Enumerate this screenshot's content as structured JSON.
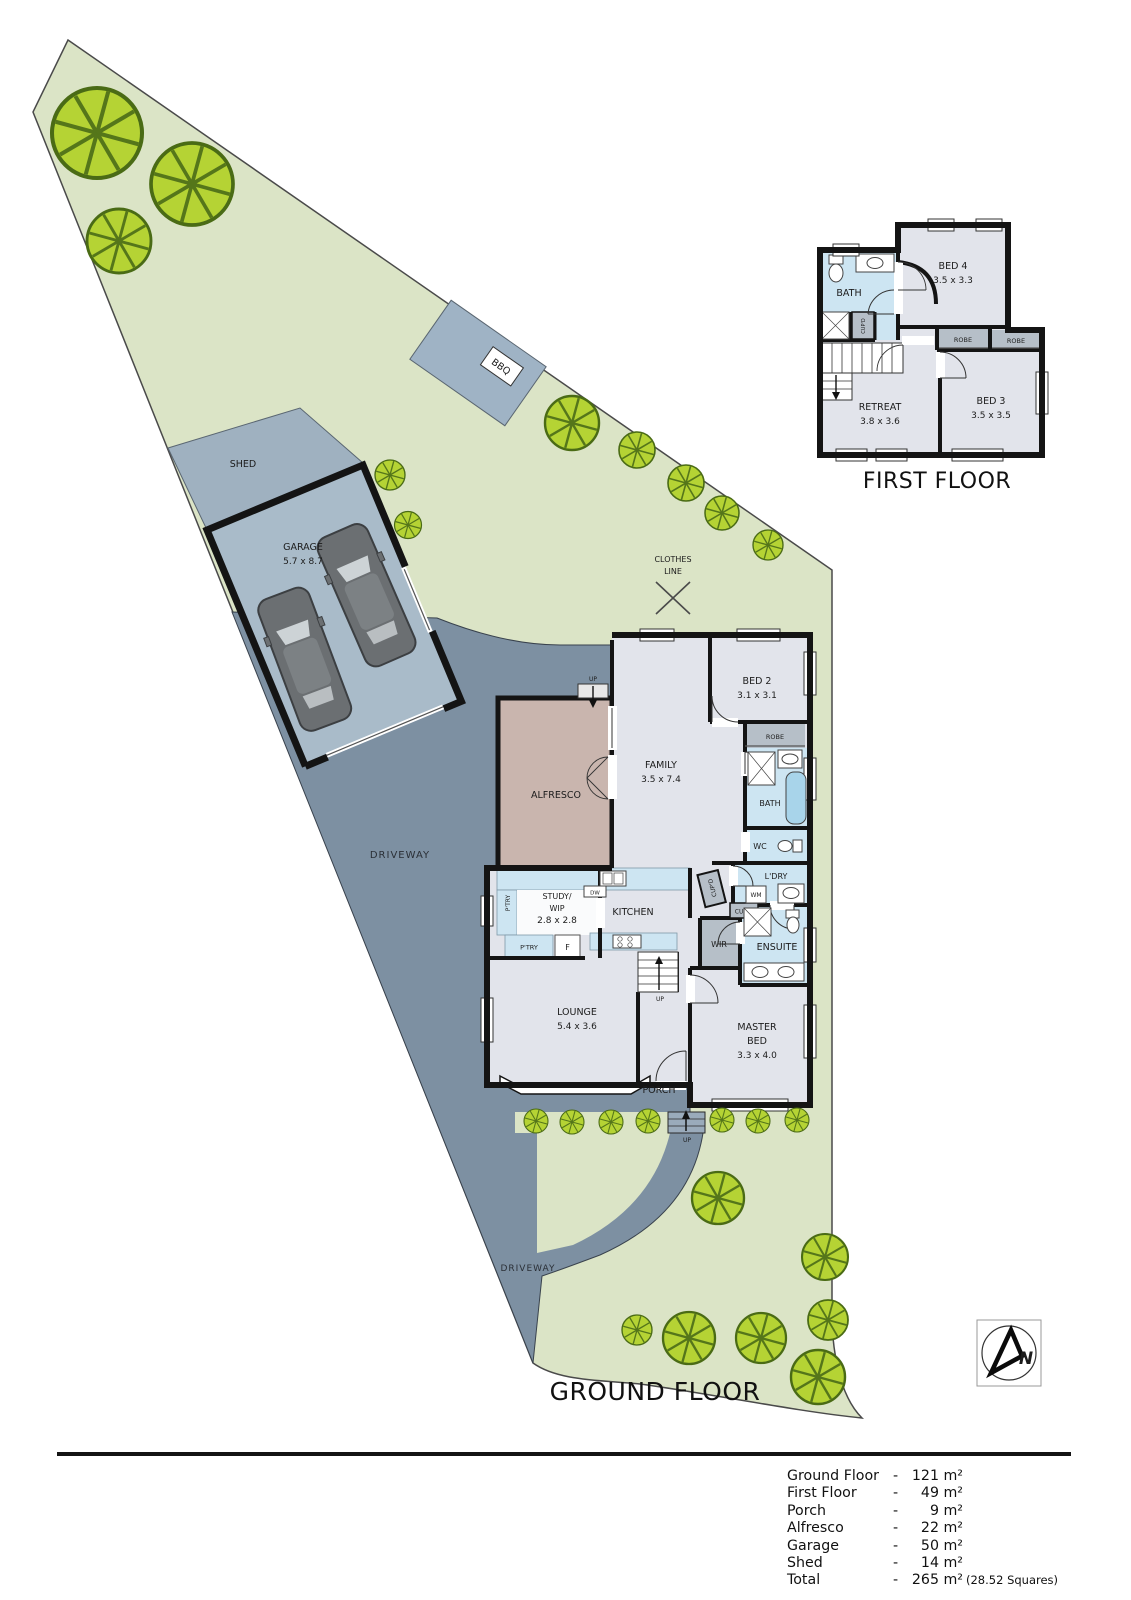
{
  "titles": {
    "first_floor": "FIRST FLOOR",
    "ground_floor": "GROUND FLOOR"
  },
  "site": {
    "shed": "SHED",
    "garage_name": "GARAGE",
    "garage_dims": "5.7 x 8.7",
    "bbq": "BBQ",
    "clothes_line_1": "CLOTHES",
    "clothes_line_2": "LINE",
    "driveway_upper": "DRIVEWAY",
    "driveway_lower": "DRIVEWAY",
    "porch": "PORCH"
  },
  "ground": {
    "family_name": "FAMILY",
    "family_dims": "3.5 x 7.4",
    "bed2_name": "BED 2",
    "bed2_dims": "3.1 x 3.1",
    "robe": "ROBE",
    "bath": "BATH",
    "wc": "WC",
    "ldry": "L'DRY",
    "wm": "WM",
    "cupd_vert": "CUP'D",
    "cupd_horiz": "CUP'D",
    "ensuite": "ENSUITE",
    "wir": "WIR",
    "master_1": "MASTER",
    "master_2": "BED",
    "master_dims": "3.3 x 4.0",
    "kitchen": "KITCHEN",
    "dw": "DW",
    "study_1": "STUDY/",
    "study_2": "WIP",
    "study_dims": "2.8 x 2.8",
    "ptry_vert": "P'TRY",
    "ptry_horiz": "P'TRY",
    "fridge": "F",
    "lounge_name": "LOUNGE",
    "lounge_dims": "5.4 x 3.6",
    "alfresco": "ALFRESCO",
    "up_alfresco": "UP",
    "up_stairs": "UP",
    "up_porch": "UP"
  },
  "first": {
    "bath": "BATH",
    "bed4_name": "BED 4",
    "bed4_dims": "3.5 x 3.3",
    "robe_left": "ROBE",
    "robe_right": "ROBE",
    "bed3_name": "BED 3",
    "bed3_dims": "3.5 x 3.5",
    "retreat_name": "RETREAT",
    "retreat_dims": "3.8 x 3.6",
    "cupd": "CUP'D"
  },
  "legend": {
    "dash": "-",
    "rows": [
      {
        "label": "Ground Floor",
        "value": "121 m²"
      },
      {
        "label": "First Floor",
        "value": "49 m²"
      },
      {
        "label": "Porch",
        "value": "9 m²"
      },
      {
        "label": "Alfresco",
        "value": "22 m²"
      },
      {
        "label": "Garage",
        "value": "50 m²"
      },
      {
        "label": "Shed",
        "value": "14 m²"
      },
      {
        "label": "Total",
        "value": "265 m²",
        "suffix": "(28.52 Squares)"
      }
    ]
  },
  "compass": {
    "n": "N"
  },
  "colors": {
    "site_green": "#dbe4c6",
    "driveway": "#7d90a2",
    "pad": "#a9bbc9",
    "shed_pad": "#9fb1c0",
    "room": "#e2e4eb",
    "wet": "#cde5f2",
    "hatch": "#b6bfc8",
    "alfresco": "#c9b5ae",
    "tree_fill": "#b5d334",
    "tree_line": "#55761a",
    "wall": "#141414",
    "tub": "#a8d4ea"
  }
}
